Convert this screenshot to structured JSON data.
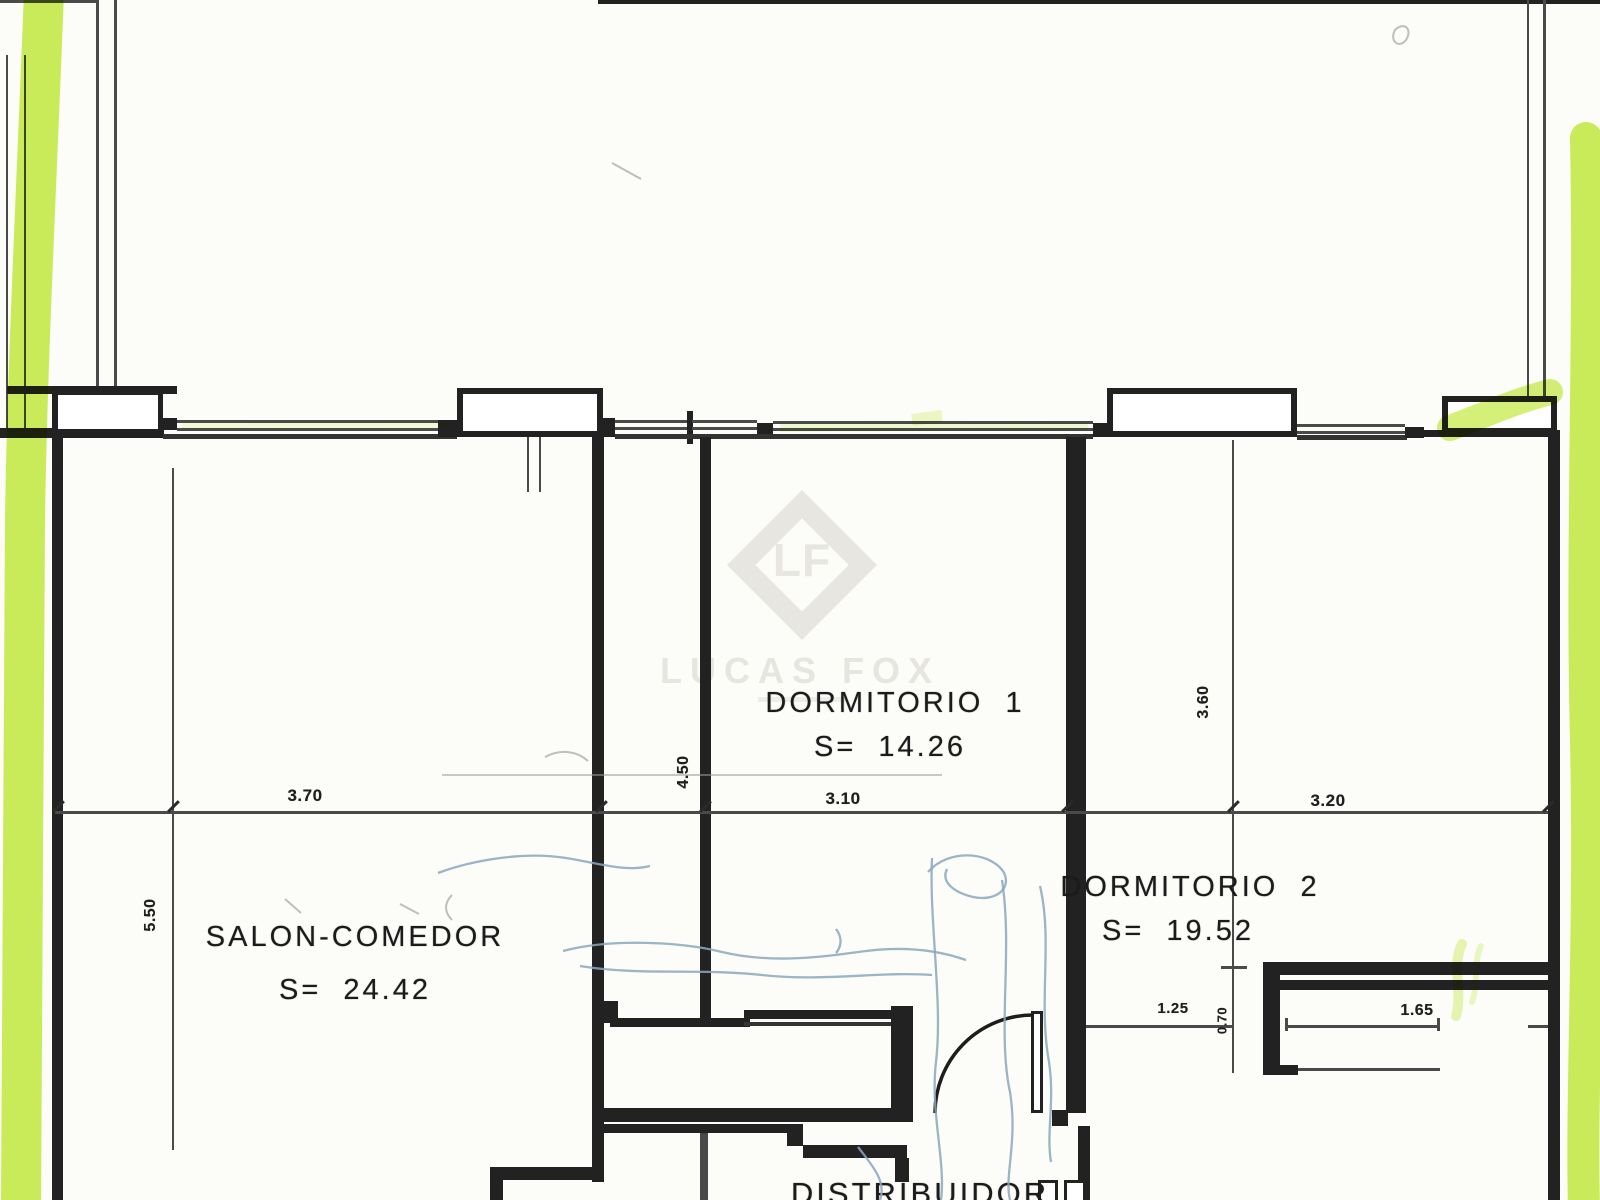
{
  "watermark": {
    "monogram": "LF",
    "brand": "LUCAS FOX"
  },
  "rooms": {
    "salon": {
      "name": "SALON-COMEDOR",
      "area": "S=  24.42"
    },
    "dorm1": {
      "name": "DORMITORIO  1",
      "area": "S=  14.26"
    },
    "dorm2": {
      "name": "DORMITORIO  2",
      "area": "S=  19.52"
    },
    "hall": {
      "name": "DISTRIBUIDOR"
    }
  },
  "dimensions": {
    "salon_width": "3.70",
    "dorm1_width": "3.10",
    "dorm2_width": "3.20",
    "salon_depth": "5.50",
    "dorm1_depth": "4.50",
    "dorm2_depth": "3.60",
    "opening_width": "1.25",
    "jamb_depth": "0.70",
    "wardrobe_width": "1.65"
  },
  "colors": {
    "ink": "#222222",
    "highlighter": "#c3ea3e",
    "pen_annotation": "#8aa7bd",
    "watermark": "#e7e6e1"
  }
}
